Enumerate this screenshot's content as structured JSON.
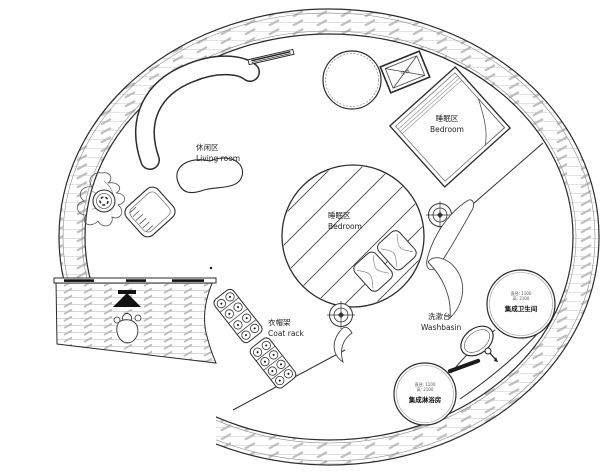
{
  "plan": {
    "type": "circular-tiny-house-floor-plan",
    "areas": {
      "living_room": {
        "zh": "休闲区",
        "en": "Living room"
      },
      "bedroom_upper": {
        "zh": "睡眠区",
        "en": "Bedroom"
      },
      "bedroom_center": {
        "zh": "睡眠区",
        "en": "Bedroom"
      },
      "coat_rack": {
        "zh": "衣帽架",
        "en": "Coat rack"
      },
      "washbasin": {
        "zh": "洗漱台",
        "en": "Washbasin"
      },
      "bathroom_pod": {
        "name": "集成卫生间",
        "spec_line1": "直径: 1100",
        "spec_line2": "高: 2100"
      },
      "shower_pod": {
        "name": "集成淋浴房",
        "spec_line1": "直径: 1100",
        "spec_line2": "高: 2100"
      },
      "ac_unit": {
        "zh": "空调"
      }
    },
    "colors": {
      "line": "#2b2b2b",
      "hatch_light": "#e0e0e0",
      "hatch_dash": "#bdbdbd",
      "background": "#ffffff"
    }
  }
}
